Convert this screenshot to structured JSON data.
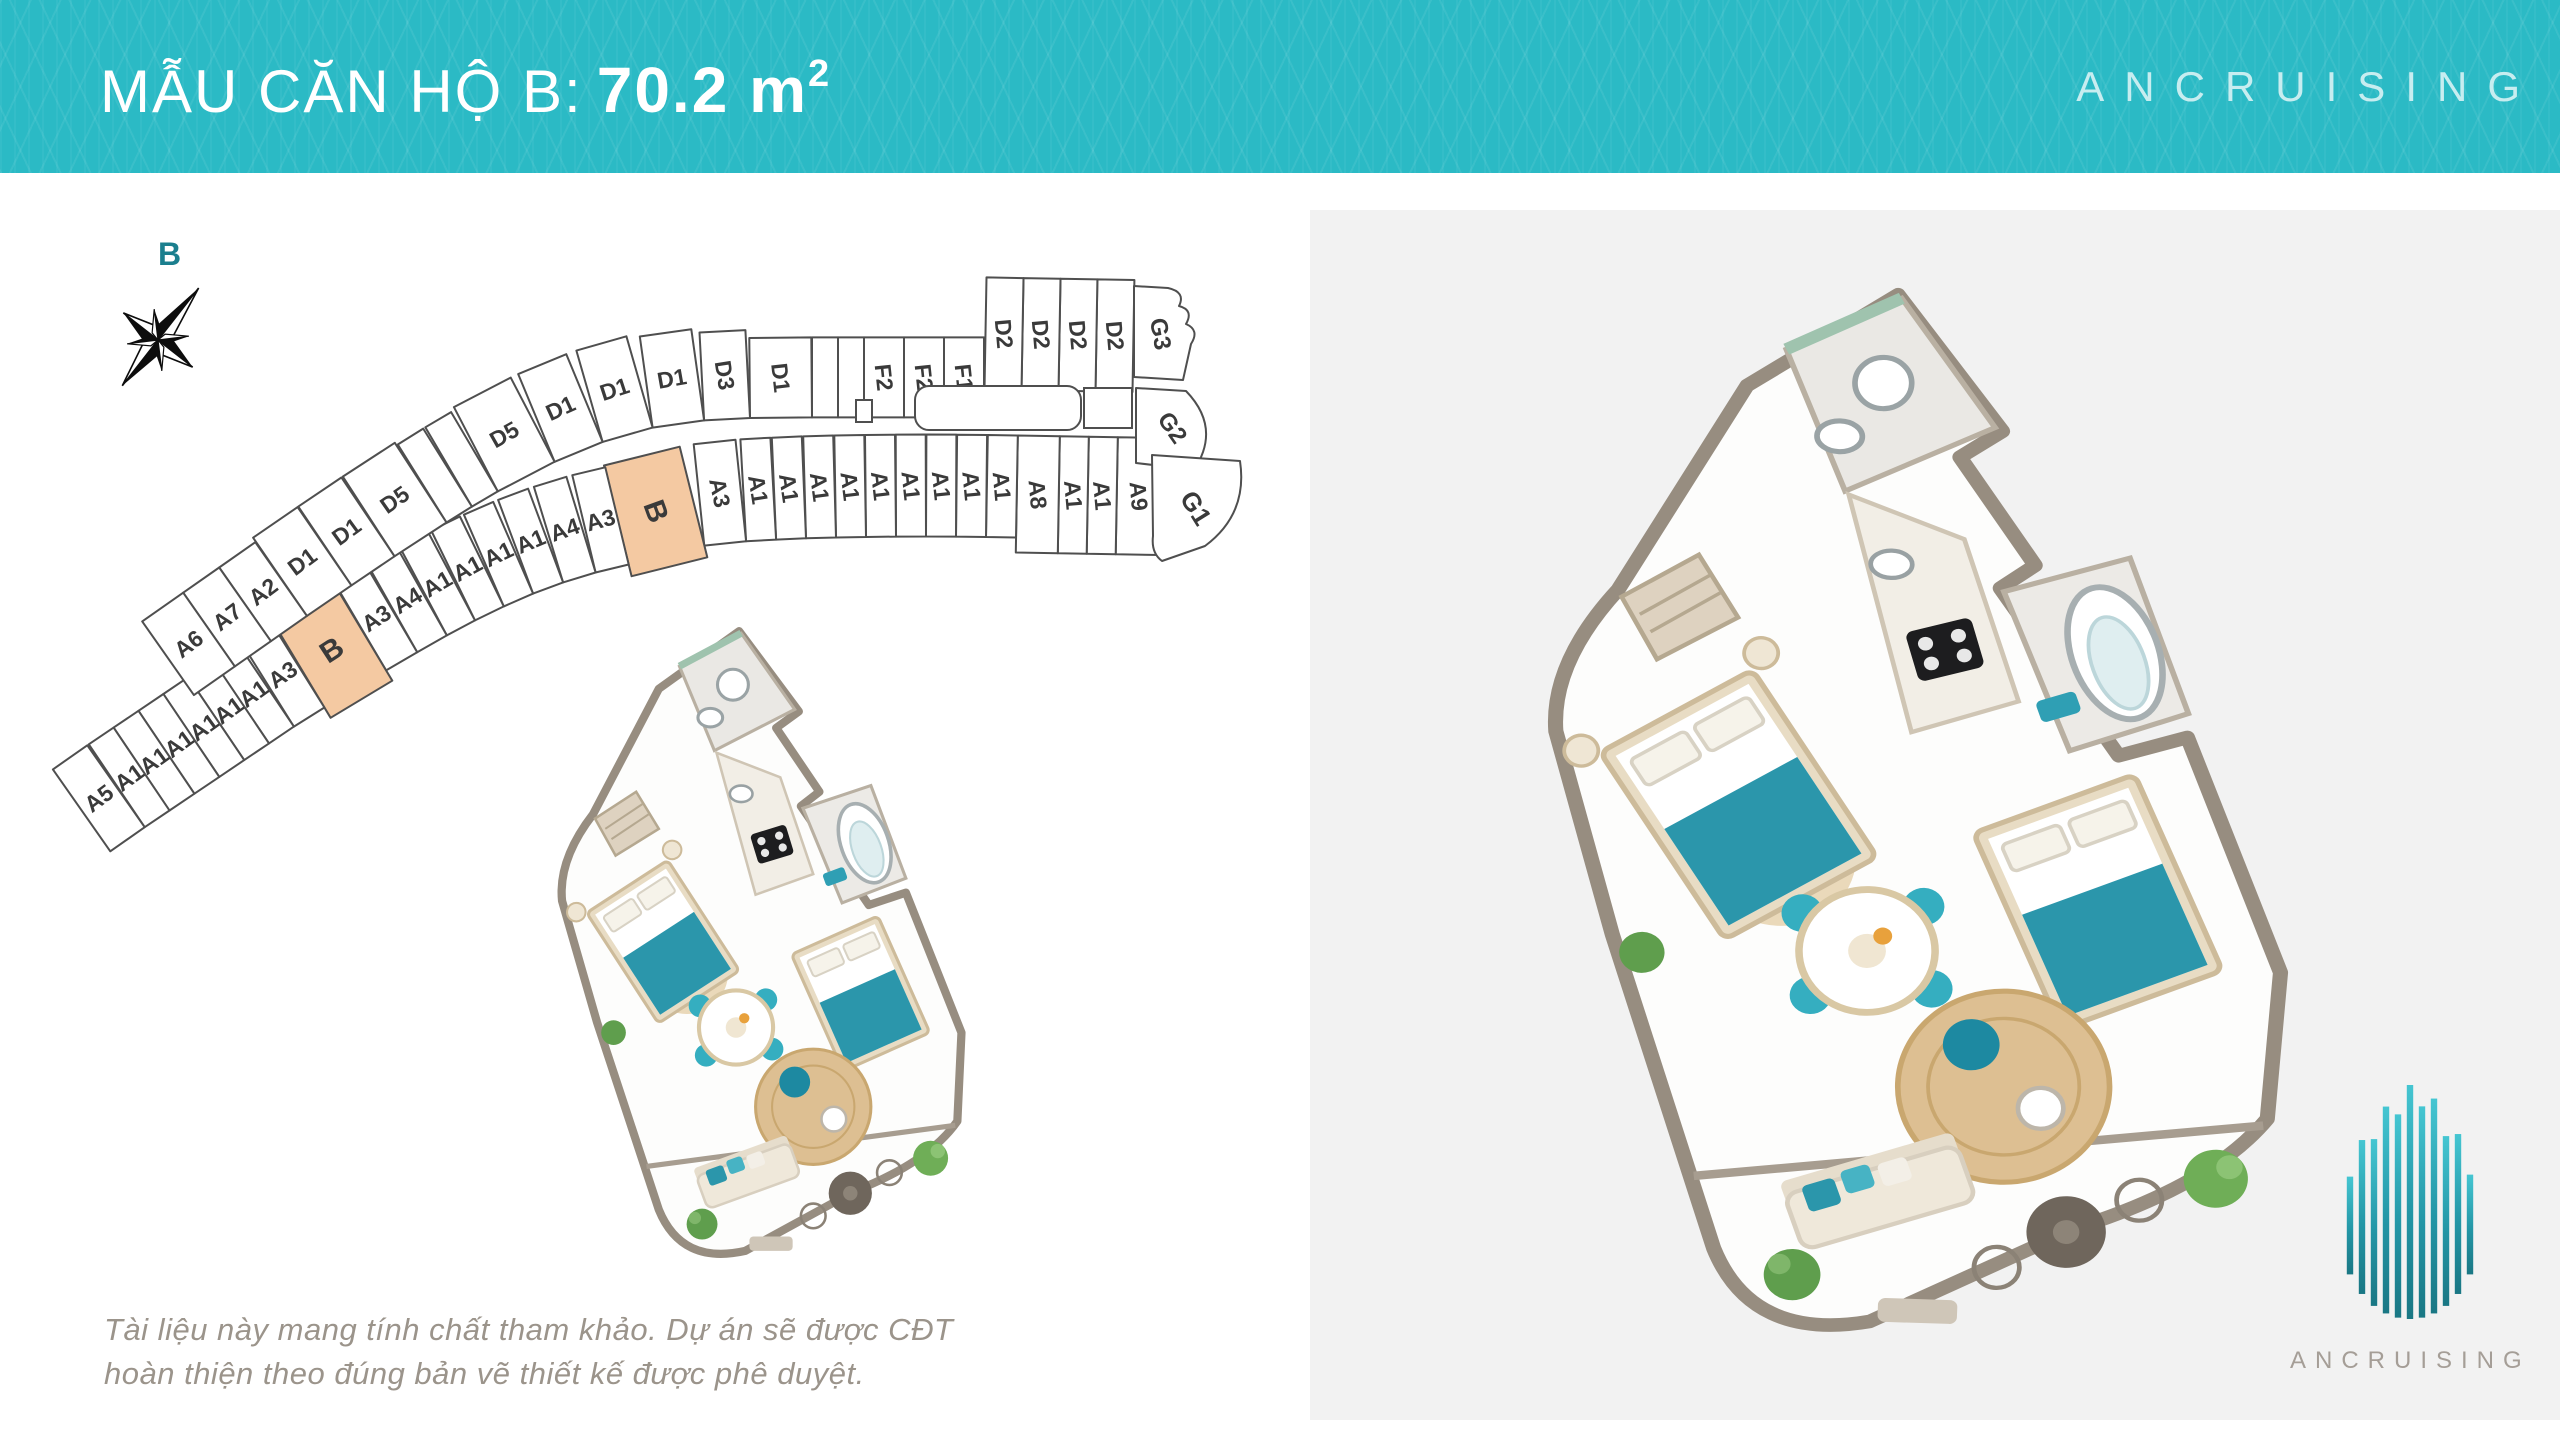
{
  "header": {
    "title_label": "MẪU CĂN HỘ B:",
    "area_value": "70.2 m",
    "area_superscript": "2",
    "brand": "ANCRUISING",
    "accent_color": "#2bbac5"
  },
  "compass": {
    "north_label": "B"
  },
  "keyplan": {
    "highlight_color": "#f4c9a2",
    "line_color": "#4f4f4f",
    "inner_labels": [
      "A9",
      "A1",
      "A1",
      "A8",
      "A1",
      "A1",
      "A1",
      "A1",
      "A1",
      "A1",
      "A1",
      "A1",
      "A1",
      "A3",
      "B",
      "A3",
      "A4",
      "A1",
      "A1",
      "A1",
      "A1",
      "A4",
      "A3",
      "B",
      "A3",
      "A1",
      "A1",
      "A1",
      "A1",
      "A1",
      "A1",
      "A5"
    ],
    "inner_highlights": [
      14,
      23
    ],
    "outer_labels": [
      "D2",
      "D2",
      "D2",
      "D2",
      "F1",
      "F2",
      "F2",
      "",
      "",
      "D1",
      "D3",
      "D1",
      "D1",
      "D1",
      "D5",
      "",
      "",
      "D5",
      "D1",
      "D1",
      "A2",
      "A7",
      "A6"
    ],
    "cap_labels": [
      "G3",
      "G2",
      "G1"
    ]
  },
  "footer": {
    "disclaimer_line1": "Tài liệu này mang tính chất tham khảo. Dự án sẽ được CĐT",
    "disclaimer_line2": "hoàn thiện theo đúng bản vẽ thiết kế được phê duyệt."
  },
  "logo": {
    "brand": "ANCRUISING"
  }
}
